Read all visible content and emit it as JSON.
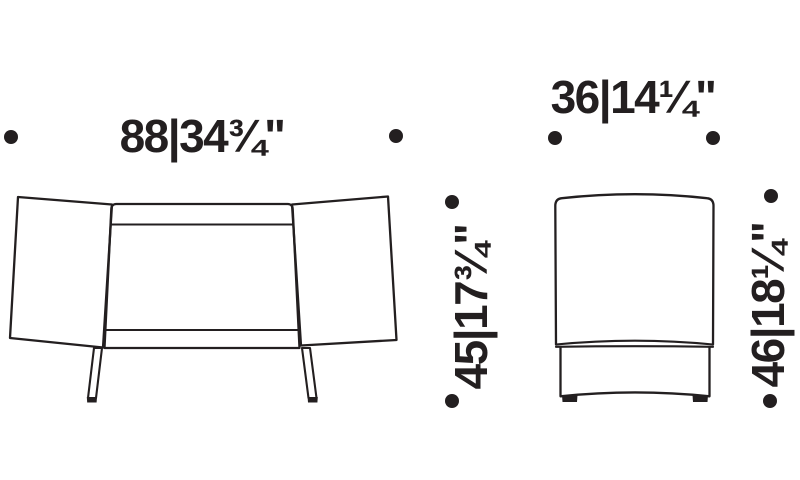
{
  "page": {
    "background": "#ffffff",
    "ink": "#231f20"
  },
  "views": [
    {
      "id": "front",
      "name": "front elevation drawing"
    },
    {
      "id": "side",
      "name": "side elevation drawing"
    }
  ],
  "dimensions": [
    {
      "id": "front-width",
      "label": "88|34¾\"",
      "orientation": "horizontal"
    },
    {
      "id": "side-depth",
      "label": "36|14¼\"",
      "orientation": "horizontal"
    },
    {
      "id": "front-height",
      "label": "45|17¾\"",
      "orientation": "vertical"
    },
    {
      "id": "side-height",
      "label": "46|18¼\"",
      "orientation": "vertical"
    }
  ]
}
